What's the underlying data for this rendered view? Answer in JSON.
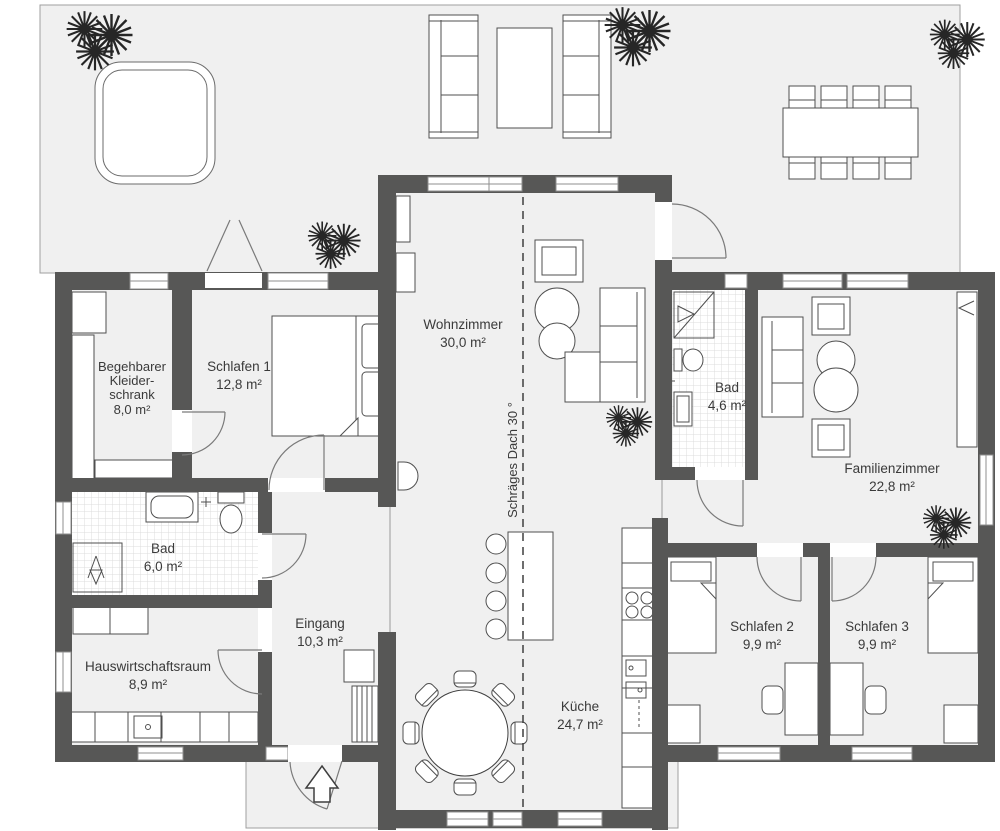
{
  "plan": {
    "rooms": [
      {
        "id": "begehbarer-kleiderschrank",
        "name_lines": [
          "Begehbarer",
          "Kleider-",
          "schrank"
        ],
        "area": "8,0 m²"
      },
      {
        "id": "schlafen-1",
        "name_lines": [
          "Schlafen 1"
        ],
        "area": "12,8 m²"
      },
      {
        "id": "wohnzimmer",
        "name_lines": [
          "Wohnzimmer"
        ],
        "area": "30,0 m²"
      },
      {
        "id": "bad-klein",
        "name_lines": [
          "Bad"
        ],
        "area": "4,6 m²"
      },
      {
        "id": "familienzimmer",
        "name_lines": [
          "Familienzimmer"
        ],
        "area": "22,8 m²"
      },
      {
        "id": "bad-gross",
        "name_lines": [
          "Bad"
        ],
        "area": "6,0 m²"
      },
      {
        "id": "eingang",
        "name_lines": [
          "Eingang"
        ],
        "area": "10,3 m²"
      },
      {
        "id": "hauswirtschaftsraum",
        "name_lines": [
          "Hauswirtschaftsraum"
        ],
        "area": "8,9 m²"
      },
      {
        "id": "kueche",
        "name_lines": [
          "Küche"
        ],
        "area": "24,7 m²"
      },
      {
        "id": "schlafen-2",
        "name_lines": [
          "Schlafen 2"
        ],
        "area": "9,9 m²"
      },
      {
        "id": "schlafen-3",
        "name_lines": [
          "Schlafen 3"
        ],
        "area": "9,9 m²"
      }
    ],
    "annotations": {
      "roof_label": "Schräges Dach 30 °"
    },
    "colors": {
      "wall": "#575756",
      "floor": "#f0f0f0",
      "outline": "#4f4f4f",
      "text": "#3a3a3a"
    }
  }
}
